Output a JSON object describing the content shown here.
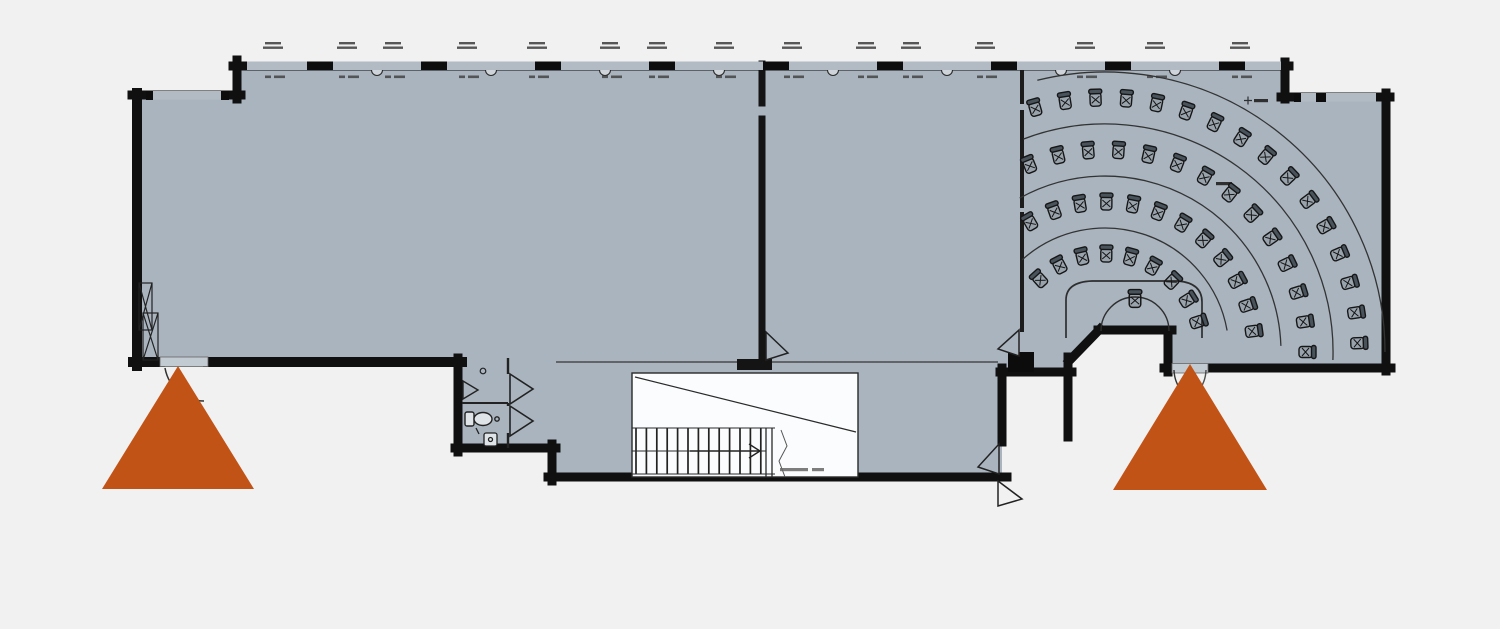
{
  "title": "ground-floor-plan",
  "colors": {
    "page_background": "#f1f1f2",
    "floor_fill": "#a9b4be",
    "wall": "#101010",
    "thin_line": "#2e2e2e",
    "window_band": "#b2bbc3",
    "door_leaf": "#c3cbd2",
    "stair_fill": "#fbfcfd",
    "exit_marker": "#c25316",
    "tiny_text_mark": "#3c3c3c"
  },
  "exit_markers": {
    "color": "#c25316",
    "items": [
      {
        "side": "left",
        "apex": [
          178,
          366
        ],
        "base_left": [
          102,
          489
        ],
        "base_right": [
          254,
          489
        ]
      },
      {
        "side": "right",
        "apex": [
          1190,
          364
        ],
        "base_left": [
          1113,
          490
        ],
        "base_right": [
          1267,
          490
        ]
      }
    ]
  },
  "top_window_band": {
    "x1": 247,
    "x2": 1281,
    "y": 61.5,
    "height": 8.5,
    "mullion_xs": [
      320,
      434,
      548,
      662,
      776,
      890,
      1004,
      1118,
      1232
    ],
    "vent_xs": [
      377,
      491,
      605,
      719,
      833,
      947,
      1061,
      1175
    ],
    "label_xs": [
      273,
      347,
      393,
      467,
      537,
      610,
      657,
      724,
      792,
      866,
      911,
      985,
      1085,
      1155,
      1240
    ],
    "label_line_count": 2,
    "window_label_count": 15
  },
  "amphitheater": {
    "center": {
      "x": 1105,
      "y": 352
    },
    "seat_rows": [
      {
        "radius": 98,
        "start_deg": 132,
        "end_deg": 18,
        "count": 9
      },
      {
        "radius": 150,
        "start_deg": 120,
        "end_deg": 8,
        "count": 12
      },
      {
        "radius": 202,
        "start_deg": 112,
        "end_deg": 0,
        "count": 14
      },
      {
        "radius": 254,
        "start_deg": 106,
        "end_deg": 2,
        "count": 16
      }
    ],
    "guide_arcs": [
      {
        "radius": 124,
        "start_deg": 132,
        "end_deg": 10
      },
      {
        "radius": 176,
        "start_deg": 119,
        "end_deg": 2
      },
      {
        "radius": 228,
        "start_deg": 111,
        "end_deg": -2
      },
      {
        "radius": 280,
        "start_deg": 104,
        "end_deg": 0
      }
    ],
    "total_seats": 51
  },
  "stairs": {
    "tread_count": 13,
    "tread_x0": 636,
    "tread_step": 10.4,
    "tread_y0": 428,
    "tread_y1": 474
  }
}
